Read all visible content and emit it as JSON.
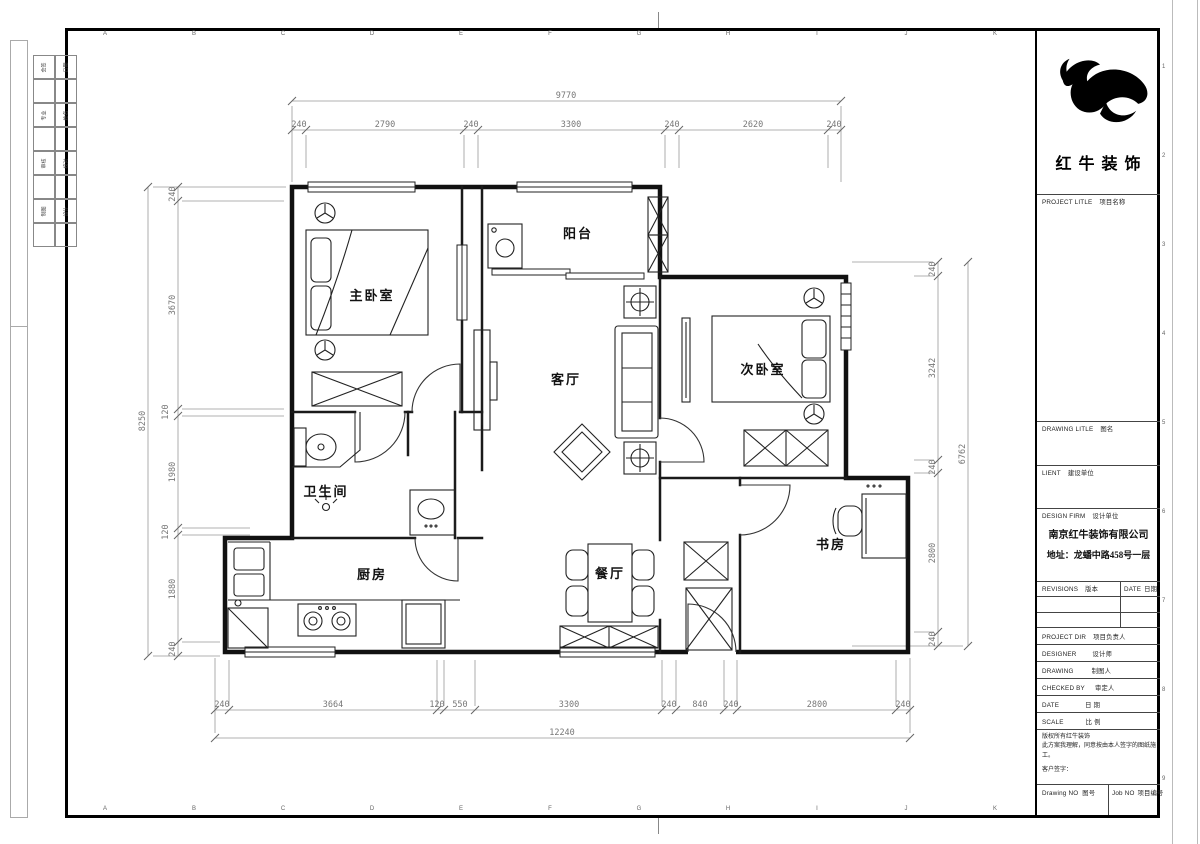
{
  "sheet": {
    "grid_letters": [
      "A",
      "B",
      "C",
      "D",
      "E",
      "F",
      "G",
      "H",
      "I",
      "J",
      "K"
    ],
    "edge_numbers": [
      "1",
      "2",
      "3",
      "4",
      "5",
      "6",
      "7",
      "8",
      "9"
    ]
  },
  "signature_strip": {
    "rows": [
      {
        "cells": [
          "会签",
          "日期"
        ]
      },
      {
        "cells": [
          "专业",
          "姓名"
        ]
      },
      {
        "cells": [
          "审核",
          "校对"
        ]
      },
      {
        "cells": [
          "制图",
          "设计"
        ]
      }
    ]
  },
  "title_block": {
    "brand": "红牛装饰",
    "project_label": "PROJECT LITLE",
    "project_label_zh": "项目名称",
    "drawing_label": "DRAWING LITLE",
    "drawing_label_zh": "图名",
    "client_label": "LIENT",
    "client_label_zh": "建设单位",
    "design_firm_label": "DESIGN FIRM",
    "design_firm_label_zh": "设计单位",
    "company_name": "南京红牛装饰有限公司",
    "company_address": "地址：龙蟠中路458号一层",
    "revisions_label": "REVISIONS",
    "revisions_label_zh": "版本",
    "date_col_label": "DATE",
    "date_col_label_zh": "日期",
    "rows": [
      {
        "en": "PROJECT DIR",
        "zh": "项目负责人"
      },
      {
        "en": "DESIGNER",
        "zh": "设计师"
      },
      {
        "en": "DRAWING",
        "zh": "制图人"
      },
      {
        "en": "CHECKED BY",
        "zh": "审定人"
      },
      {
        "en": "DATE",
        "zh": "日  期"
      },
      {
        "en": "SCALE",
        "zh": "比  例"
      }
    ],
    "copyright_line1": "版权所有红牛装饰",
    "copyright_line2": "此方案我理解，同意按由本人签字的图纸施工。",
    "signature_label": "客户签字：",
    "drawing_no_label": "Drawing NO",
    "drawing_no_label_zh": "图号",
    "job_no_label": "Job NO",
    "job_no_label_zh": "项目编号"
  },
  "rooms": [
    {
      "label": "主卧室"
    },
    {
      "label": "阳台"
    },
    {
      "label": "次卧室"
    },
    {
      "label": "客厅"
    },
    {
      "label": "卫生间"
    },
    {
      "label": "厨房"
    },
    {
      "label": "餐厅"
    },
    {
      "label": "书房"
    }
  ],
  "dims": {
    "top_overall": "9770",
    "top_segments": [
      "240",
      "2790",
      "240",
      "3300",
      "240",
      "2620",
      "240"
    ],
    "left_overall": "8250",
    "left_segments": [
      "240",
      "3670",
      "120",
      "1980",
      "120",
      "1880",
      "240"
    ],
    "right_overall": "6762",
    "right_segments": [
      "240",
      "3242",
      "240",
      "2800",
      "240"
    ],
    "bottom_overall": "12240",
    "bottom_segments": [
      "240",
      "3664",
      "120",
      "550",
      "3300",
      "240",
      "840",
      "240",
      "2800",
      "240"
    ]
  }
}
